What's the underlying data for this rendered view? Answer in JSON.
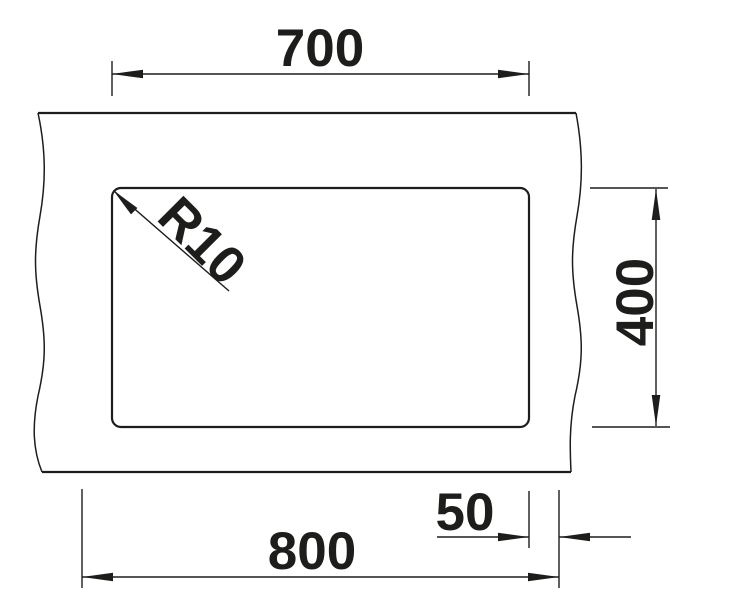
{
  "drawing": {
    "colors": {
      "line": "#1d1d1b",
      "background": "#ffffff"
    },
    "labels": {
      "cutout_width": "700",
      "cutout_depth": "400",
      "corner_radius": "R10",
      "edge_offset": "50",
      "overall_width": "800"
    }
  }
}
